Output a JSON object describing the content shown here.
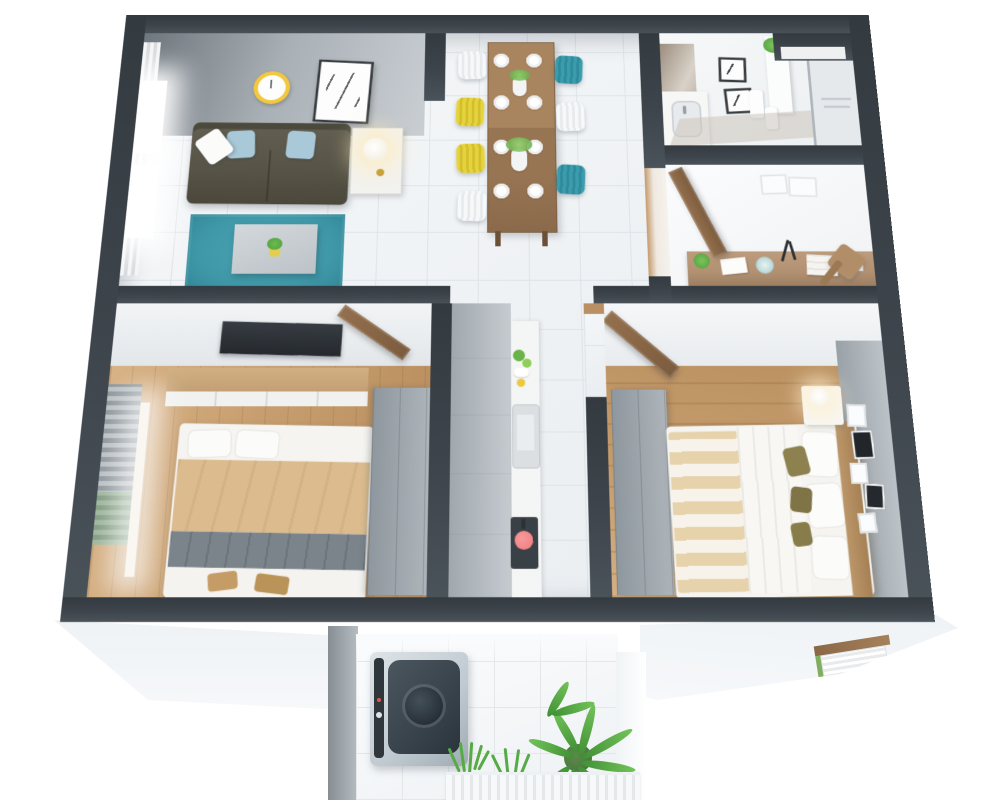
{
  "scene": {
    "title": "3D isometric cutaway floor plan of a two-bedroom apartment",
    "view": "top-down axonometric render, white background",
    "background": "#ffffff"
  },
  "palette": {
    "wall": "#3d444b",
    "tile": "#eef1f4",
    "tileLine": "#dde2e6",
    "wood": "#c79e6f",
    "rug": "#3f98a8",
    "sofa": "#575447",
    "sofaBack": "#4c4a3c",
    "pillowBlue": "#a9c9d9",
    "tan": "#dcbc8e",
    "throw": "#7b838b",
    "sheet": "#f5f4f1",
    "wardrobeA": "#8f979e",
    "wardrobeB": "#adb4ba",
    "doorA": "#93704e",
    "doorB": "#7c5c3e",
    "tableWood": "#977452",
    "teal": "#3a9cad",
    "yellow": "#e6d33c",
    "cabA": "#a0a8ae",
    "cabB": "#c6cbd0",
    "stove": "#394046",
    "pan": "#ef7a7d",
    "washerBody": "#bfc9d0",
    "washerLid": "#39444d",
    "drum": "#272f36",
    "leafA": "#57ab45",
    "leafB": "#73c35a",
    "pot": "#47703b",
    "slab": "#f6f8fa",
    "accent": "#99a1a8",
    "desk": "#b29173",
    "clockRing": "#f2c83e"
  },
  "rooms": [
    {
      "id": "living-room",
      "name": "Living room",
      "furniture": [
        "window with sheer curtain",
        "wall clock (yellow ring)",
        "framed abstract art",
        "olive three-seat sofa",
        "light-blue cushions",
        "white cushion",
        "white side table",
        "table lamp (lit)",
        "teal area rug",
        "gray coffee table",
        "small potted plant"
      ]
    },
    {
      "id": "dining-area",
      "name": "Dining area",
      "furniture": [
        "wooden dining table",
        "8 white place settings",
        "2 flower vases",
        "7 spindle chairs"
      ],
      "chairs": [
        "white",
        "yellow",
        "yellow",
        "white",
        "teal",
        "white",
        "teal"
      ]
    },
    {
      "id": "bathroom",
      "name": "Bathroom",
      "furniture": [
        "vanity with sink",
        "mirror",
        "two dark-framed prints",
        "white shelf with plant",
        "towels",
        "floor mat",
        "glass shower with towel rack",
        "duct shaft"
      ]
    },
    {
      "id": "hallway-study",
      "name": "Hallway / study nook",
      "furniture": [
        "open wooden door",
        "wooden desk",
        "desk plant",
        "papers",
        "decorative plate",
        "black desk lamp",
        "book stack",
        "wooden chair",
        "two faint wall frames"
      ]
    },
    {
      "id": "bedroom-1",
      "name": "Bedroom 1",
      "furniture": [
        "wall TV panel",
        "wooden sideboard with white cabinets",
        "window blinds",
        "double bed (white pillows, tan blanket, gray throw, white duvet)",
        "gray wardrobe",
        "open wooden door"
      ]
    },
    {
      "id": "kitchen-corridor",
      "name": "Kitchen corridor",
      "furniture": [
        "tall gray cabinet run",
        "white counter",
        "greens and fruit",
        "inset sink",
        "cooktop with red pan"
      ]
    },
    {
      "id": "bedroom-2",
      "name": "Bedroom 2",
      "furniture": [
        "open wooden door",
        "gray wardrobe",
        "double bed (beige striped blanket, white duvet, white and olive pillows)",
        "wooden headboard",
        "white nightstand with lamp",
        "gray accent wall with mini gallery frames"
      ]
    },
    {
      "id": "balcony",
      "name": "Balcony / laundry",
      "furniture": [
        "top-load washing machine",
        "potted fern",
        "grass plants",
        "white slatted planter box"
      ]
    }
  ],
  "structure": [
    "dark charcoal cut walls",
    "white floor slab skirt",
    "window notch with blinds on lower-right slab",
    "balcony volume protruding at bottom center"
  ]
}
